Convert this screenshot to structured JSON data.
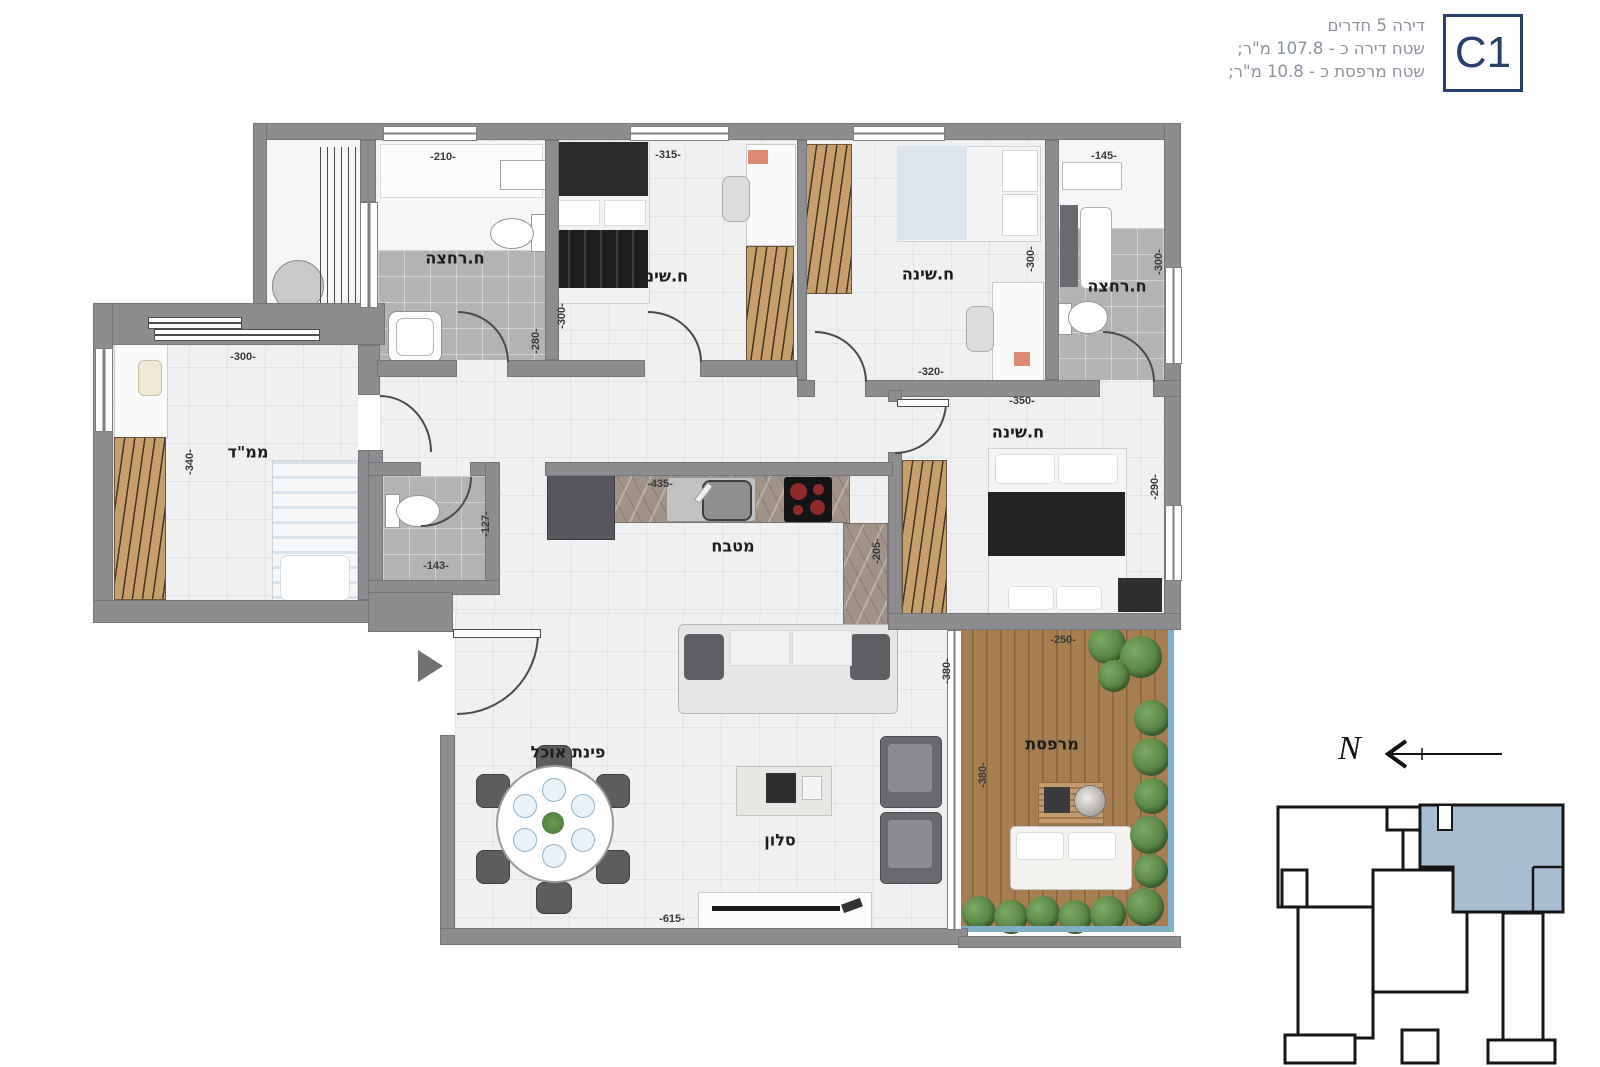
{
  "header": {
    "unit_code": "C1",
    "line1": "דירה 5 חדרים",
    "line2": "שטח דירה כ - 107.8 מ\"ר;",
    "line3": "שטח מרפסת כ - 10.8 מ\"ר;"
  },
  "rooms": {
    "bath1": "ח.רחצה",
    "bed1": "ח.שינה",
    "bed2": "ח.שינה",
    "bath2": "ח.רחצה",
    "mamad": "ממ\"ד",
    "kitchen": "מטבח",
    "master": "ח.שינה",
    "dining": "פינת אוכל",
    "living": "סלון",
    "balcony": "מרפסת"
  },
  "dims": {
    "bath1_w": "-210-",
    "bed1_w": "-315-",
    "bath2_w": "-145-",
    "bed1_h": "-300-",
    "bath1_h": "-280-",
    "bed2_h": "-300-",
    "bath2_h": "-300-",
    "bed2_w": "-320-",
    "master_w": "-350-",
    "master_h": "-290-",
    "mamad_w": "-300-",
    "mamad_h": "-340-",
    "wc_w": "-143-",
    "wc_h": "-127-",
    "kitchen_w": "-435-",
    "kitchen_h": "-205-",
    "living_h": "-380-",
    "balcony_w": "-250-",
    "balcony_h": "-380-",
    "living_w": "-615-"
  },
  "compass": {
    "north": "N"
  },
  "colors": {
    "accent_navy": "#27416b",
    "keyplan_highlight": "#a9bed3",
    "wall_gray": "#8d8d8f",
    "wood": "#c79e6e",
    "deck": "#a87e51",
    "railing_blue": "#7fb0c6"
  }
}
